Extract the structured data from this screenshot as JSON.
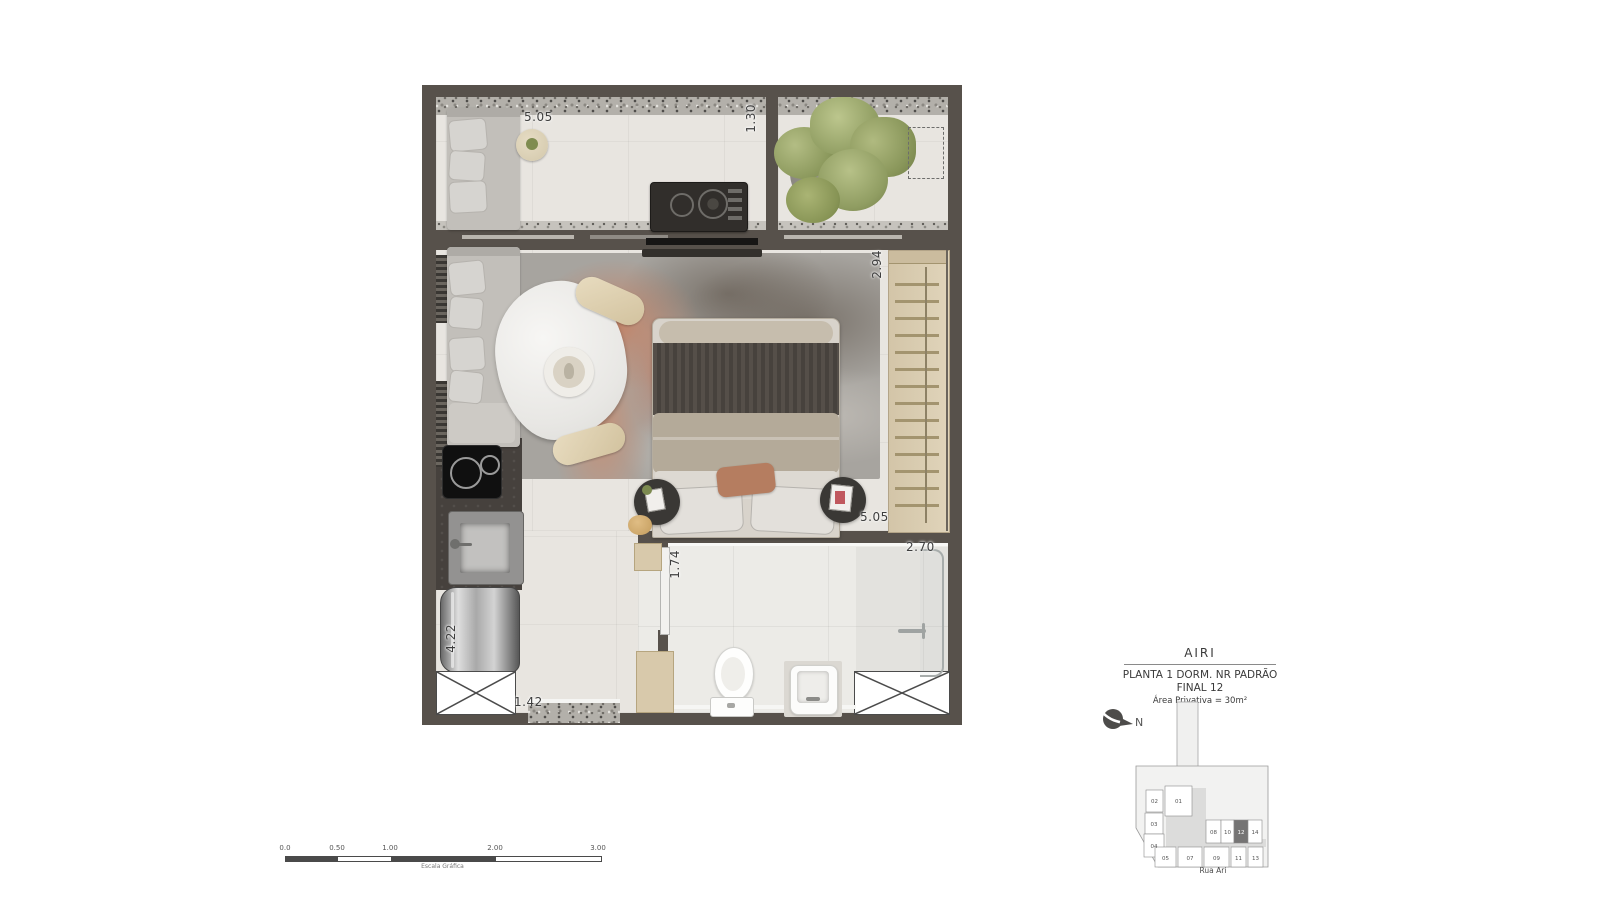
{
  "title_block": {
    "project": "AIRI",
    "plan_type": "PLANTA 1 DORM. NR PADRÃO",
    "unit": "FINAL 12",
    "private_area": "Área Privativa = 30m²"
  },
  "north_arrow": {
    "label": "N"
  },
  "key_plan": {
    "street": "Rua Ari",
    "highlighted_unit": "12",
    "units": {
      "u01": "01",
      "u02": "02",
      "u03": "03",
      "u04": "04",
      "u05": "05",
      "u07": "07",
      "u08": "08",
      "u09": "09",
      "u10": "10",
      "u11": "11",
      "u12": "12",
      "u13": "13",
      "u14": "14"
    }
  },
  "scale_bar": {
    "ticks": [
      "0.0",
      "0.50",
      "1.00",
      "2.00",
      "3.00"
    ],
    "caption": "Escala Gráfica"
  },
  "floor_plan": {
    "dimensions": {
      "terrace_width": "5.05",
      "terrace_depth": "1.30",
      "bedroom_depth": "2.94",
      "bedroom_width": "5.05",
      "bathroom_width": "2.70",
      "bathroom_door": "1.74",
      "kitchen_length": "4.22",
      "entry_width": "1.42"
    }
  },
  "colors": {
    "wall": "#57514b",
    "floor": "#e8e5e0",
    "wood": "#d9cdb2",
    "rug_accent": "#c08a72",
    "unit_highlight": "#757474"
  }
}
